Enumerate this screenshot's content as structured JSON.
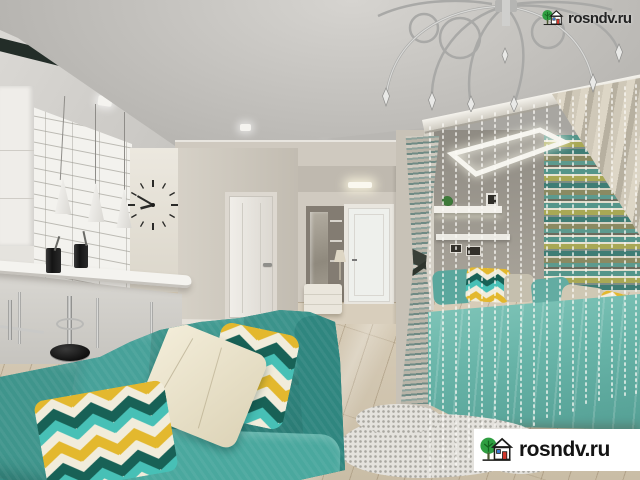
{
  "scene": {
    "description": "3D render of a studio apartment: large teal sofa with chevron pillows in the foreground, white tiled kitchen with bar counter, pendant lamps and minimalist wall clock on the left, hallway with two white doors and an ottoman in the center, and a sleeping nook on the right with a turquoise bed, striped accent wall, bead-string curtain, beige drape and a chrome chandelier on the ceiling",
    "palette": {
      "sofa_teal": "#3a9c92",
      "bed_turquoise": "#68b4a8",
      "pillow_yellow": "#e3b82e",
      "pillow_dark_teal": "#186156",
      "pillow_turquoise": "#47c0b6",
      "pillow_cream": "#f1ecdb",
      "wall_beige": "#cfc9bf",
      "ceiling_gray": "#bfbdb9",
      "floor_wood": "#cfc3ae",
      "tile_white": "#f3f2ee",
      "accent_stripe_teal": "#4f8f84",
      "accent_stripe_olive": "#a8a855"
    }
  },
  "watermarks": {
    "top": {
      "text": "rosndv.ru"
    },
    "bottom": {
      "text": "rosndv.ru"
    },
    "logo": {
      "tree_green": "#2f9e41",
      "door_red": "#d2372b",
      "window_blue": "#3a7ad4",
      "outline": "#1d1d1b",
      "box_background": "#ffffff"
    }
  }
}
